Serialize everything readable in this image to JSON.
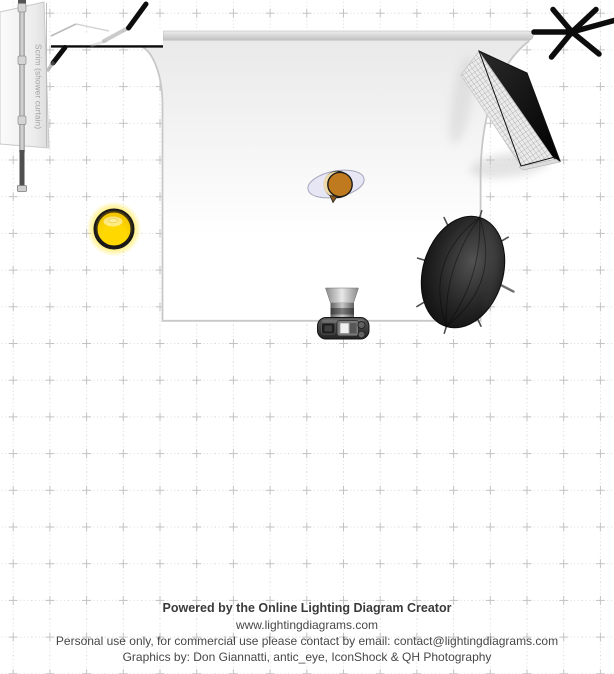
{
  "app": {
    "name": "Online Lighting Diagram Creator export"
  },
  "footer": {
    "powered_by": "Powered by the Online Lighting Diagram Creator",
    "website": "www.lightingdiagrams.com",
    "license": "Personal use only, for commercial use please contact by email: contact@lightingdiagrams.com",
    "credits": "Graphics by: Don Giannatti, antic_eye, IconShock & QH Photography"
  },
  "diagram": {
    "scrim": {
      "label": "Scrim (shower curtain)",
      "label_color": "#a3a3a3"
    },
    "colors": {
      "subject_head": "#bf7a1f",
      "subject_hair_highlight": "#eedaa6",
      "subject_body": "#e6e6f4",
      "bulb_core": "#ffd800",
      "bulb_glow": "#ffdf00",
      "equipment_black": "#111111",
      "backdrop_border": "#c8c8c8",
      "grid_dot": "#dadada",
      "grid_cross": "#c2c2c2"
    },
    "equipment": [
      {
        "id": "backdrop-sweep",
        "kind": "white seamless backdrop with roll bar"
      },
      {
        "id": "scrim-shower-curtain",
        "kind": "scrim panel on stand"
      },
      {
        "id": "white-flag-panel",
        "kind": "white panel / flag"
      },
      {
        "id": "boom-stand-left",
        "kind": "boom stand (partially hidden)"
      },
      {
        "id": "boom-stand-right",
        "kind": "boom stand top view"
      },
      {
        "id": "strip-softbox-grid",
        "kind": "gridded strip softbox"
      },
      {
        "id": "parabolic-umbrella",
        "kind": "deep black umbrella"
      },
      {
        "id": "bare-bulb-light",
        "kind": "bare bulb / sun light"
      },
      {
        "id": "subject",
        "kind": "subject head top view"
      },
      {
        "id": "camera",
        "kind": "camera top view"
      }
    ]
  }
}
